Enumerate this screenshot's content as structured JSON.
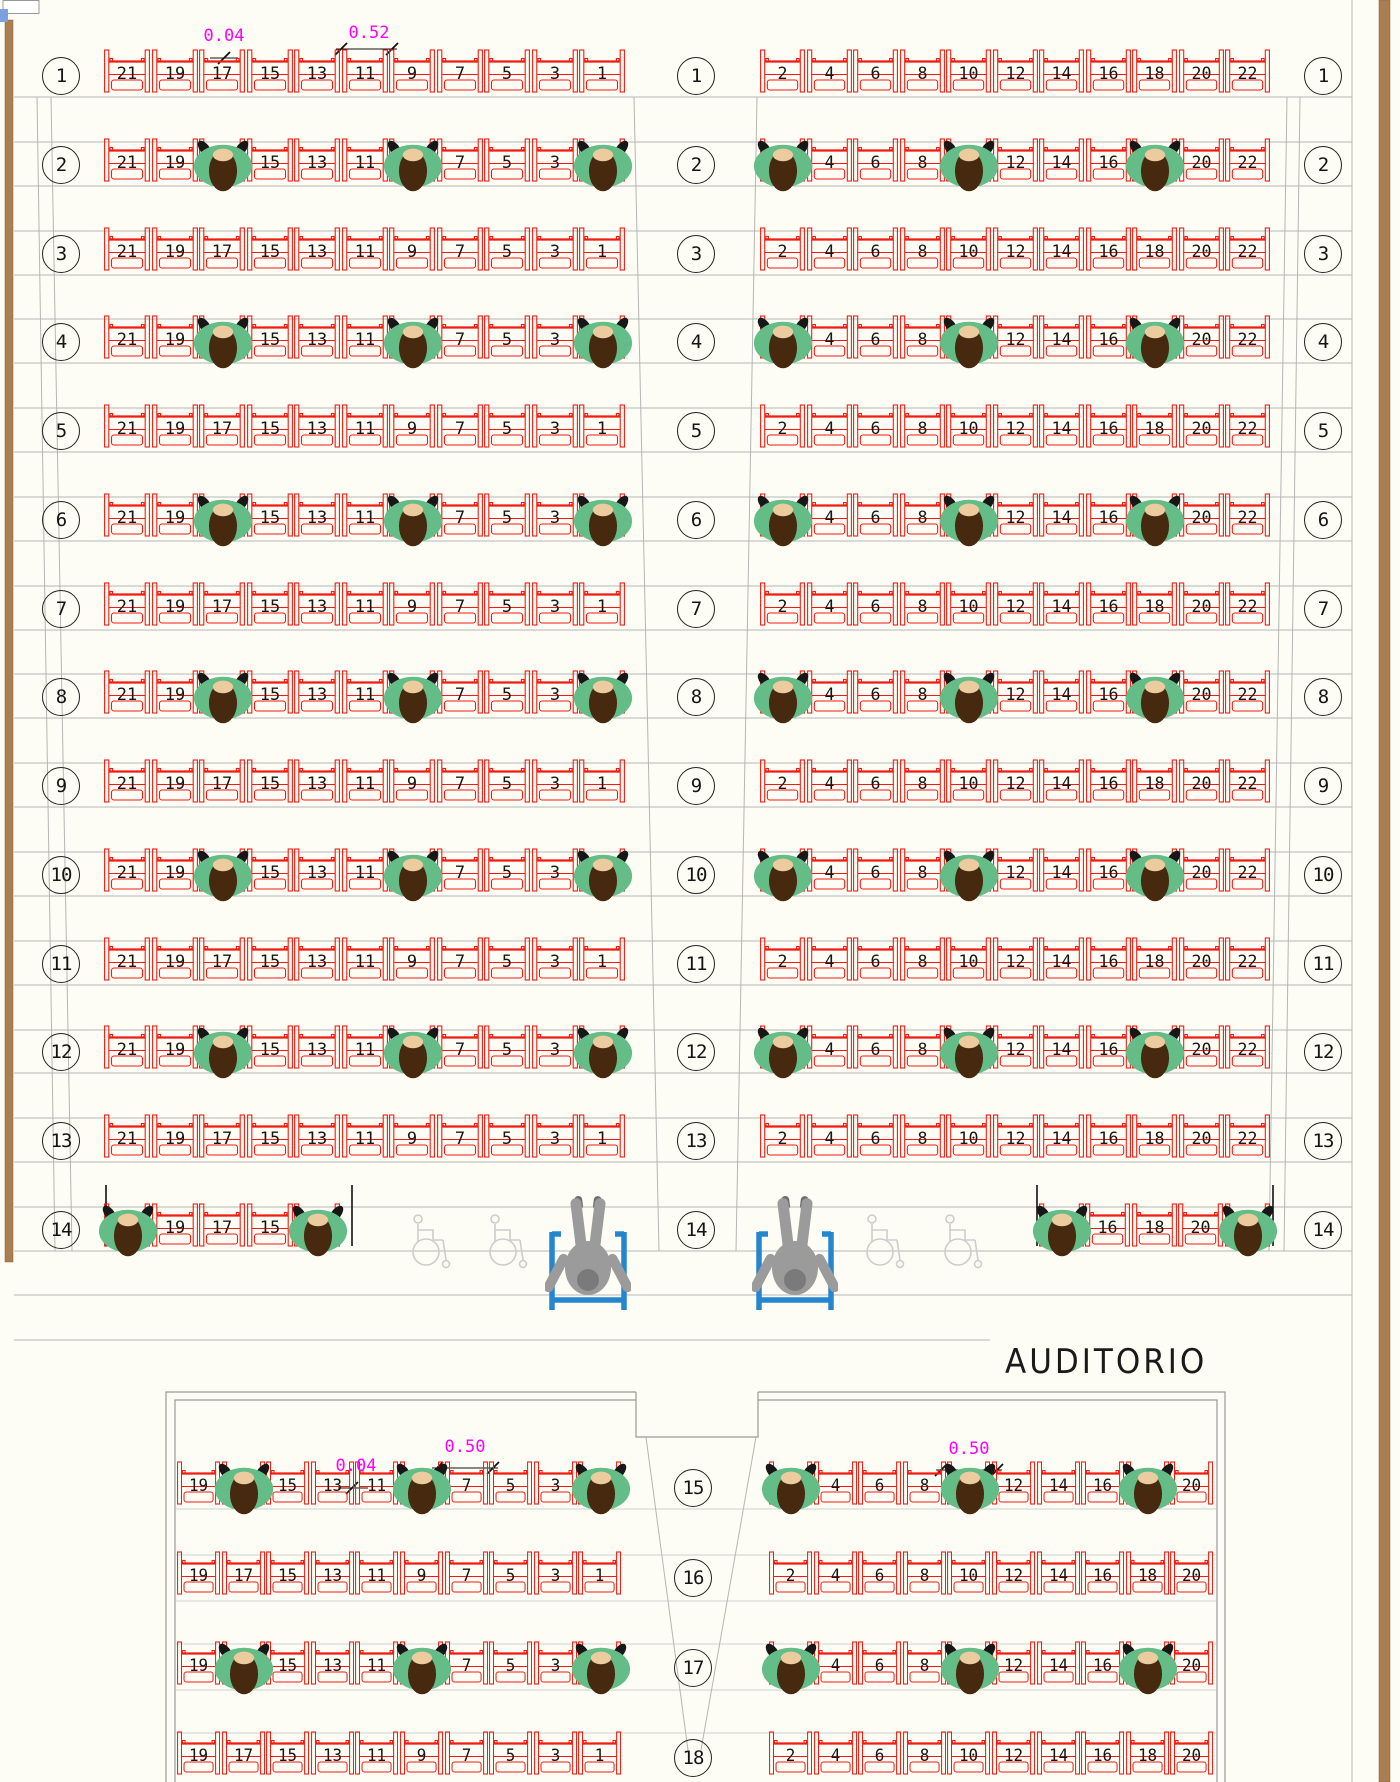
{
  "title": "AUDITORIO",
  "dimensions": {
    "top_small": "0.04",
    "top_seat": "0.52",
    "balcony_small": "0.04",
    "balcony_left": "0.50",
    "balcony_right": "0.50"
  },
  "sections": {
    "main": {
      "left_seats": [
        21,
        19,
        17,
        15,
        13,
        11,
        9,
        7,
        5,
        3,
        1
      ],
      "right_seats": [
        2,
        4,
        6,
        8,
        10,
        12,
        14,
        16,
        18,
        20,
        22
      ]
    },
    "balcony": {
      "left_seats": [
        19,
        17,
        15,
        13,
        11,
        9,
        7,
        5,
        3,
        1
      ],
      "right_seats": [
        2,
        4,
        6,
        8,
        10,
        12,
        14,
        16,
        18,
        20
      ]
    }
  },
  "rows": [
    {
      "num": 1,
      "section": "main",
      "occupied_left": [],
      "occupied_right": []
    },
    {
      "num": 2,
      "section": "main",
      "occupied_left": [
        17,
        9,
        1
      ],
      "occupied_right": [
        2,
        10,
        18
      ]
    },
    {
      "num": 3,
      "section": "main",
      "occupied_left": [],
      "occupied_right": []
    },
    {
      "num": 4,
      "section": "main",
      "occupied_left": [
        17,
        9,
        1
      ],
      "occupied_right": [
        2,
        10,
        18
      ]
    },
    {
      "num": 5,
      "section": "main",
      "occupied_left": [],
      "occupied_right": []
    },
    {
      "num": 6,
      "section": "main",
      "occupied_left": [
        17,
        9,
        1
      ],
      "occupied_right": [
        2,
        10,
        18
      ]
    },
    {
      "num": 7,
      "section": "main",
      "occupied_left": [],
      "occupied_right": []
    },
    {
      "num": 8,
      "section": "main",
      "occupied_left": [
        17,
        9,
        1
      ],
      "occupied_right": [
        2,
        10,
        18
      ]
    },
    {
      "num": 9,
      "section": "main",
      "occupied_left": [],
      "occupied_right": []
    },
    {
      "num": 10,
      "section": "main",
      "occupied_left": [
        17,
        9,
        1
      ],
      "occupied_right": [
        2,
        10,
        18
      ]
    },
    {
      "num": 11,
      "section": "main",
      "occupied_left": [],
      "occupied_right": []
    },
    {
      "num": 12,
      "section": "main",
      "occupied_left": [
        17,
        9,
        1
      ],
      "occupied_right": [
        2,
        10,
        18
      ]
    },
    {
      "num": 13,
      "section": "main",
      "occupied_left": [],
      "occupied_right": []
    },
    {
      "num": 14,
      "section": "main",
      "wheelchair_row": true,
      "left_seats": [
        21,
        19,
        17,
        15,
        13
      ],
      "right_seats": [
        14,
        16,
        18,
        20,
        22
      ],
      "occupied_left": [
        21,
        13
      ],
      "occupied_right": [
        14,
        22
      ],
      "empty_wheelchair_spaces": 4,
      "occupied_wheelchairs": 2
    },
    {
      "num": 15,
      "section": "balcony",
      "occupied_left": [
        17,
        9,
        1
      ],
      "occupied_right": [
        2,
        10,
        18
      ]
    },
    {
      "num": 16,
      "section": "balcony",
      "occupied_left": [],
      "occupied_right": []
    },
    {
      "num": 17,
      "section": "balcony",
      "occupied_left": [
        17,
        9,
        1
      ],
      "occupied_right": [
        2,
        10,
        18
      ]
    },
    {
      "num": 18,
      "section": "balcony",
      "occupied_left": [],
      "occupied_right": []
    }
  ],
  "colors": {
    "seat": "#f21b10",
    "seat_number": "#161616",
    "person_body": "#64bc87",
    "person_head": "#46290f",
    "person_hair": "#eccb9f",
    "person_shoulder": "#171717",
    "dimension": "#ff00ff",
    "wheelchair_frame": "#2586cf",
    "wheelchair_person": "#9b9b9b",
    "wheelchair_person_dark": "#7a7a7a",
    "empty_wheelchair": "#cdcdcd",
    "wall": "#a87e52",
    "floor_line": "#b5b5b5",
    "blue_marker": "#7b9fe0"
  }
}
